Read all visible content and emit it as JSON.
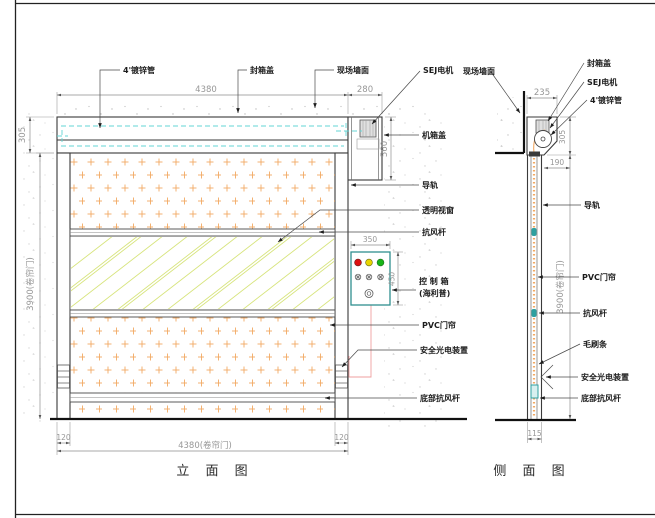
{
  "front": {
    "title": "立 面 图",
    "callout_pipe": "4'镀锌管",
    "callout_cover": "封箱盖",
    "callout_wall": "现场墙面",
    "callout_motor": "SEJ电机",
    "callout_motor_cover": "机箱盖",
    "callout_rail": "导轨",
    "callout_window": "透明视窗",
    "callout_windbar": "抗风杆",
    "callout_control1": "控 制 箱",
    "callout_control2": "(海利普)",
    "callout_curtain": "PVC门帘",
    "callout_photocell": "安全光电装置",
    "callout_bottombar": "底部抗风杆",
    "dim_width": "4380",
    "dim_head_w": "280",
    "dim_head_h": "305",
    "dim_box_h": "560",
    "dim_height": "3900(卷帘门)",
    "dim_panel_w": "350",
    "dim_panel_h": "450",
    "dim_rail_l": "120",
    "dim_rail_r": "120",
    "dim_opening": "4380(卷帘门)"
  },
  "side": {
    "title": "侧 面 图",
    "callout_wall": "现场墙面",
    "callout_cover": "封箱盖",
    "callout_motor": "SEJ电机",
    "callout_pipe": "4'镀锌管",
    "callout_rail": "导轨",
    "callout_curtain": "PVC门帘",
    "callout_windbar": "抗风杆",
    "callout_brush": "毛刷条",
    "callout_photocell": "安全光电装置",
    "callout_bottombar": "底部抗风杆",
    "dim_depth": "235",
    "dim_head_h": "305",
    "dim_offset": "190",
    "dim_height": "3900(卷帘门)",
    "dim_base": "115"
  },
  "colors": {
    "light_red": "#dd1111",
    "light_yellow": "#e8d500",
    "light_green": "#17b517",
    "curtain_dot": "#f2a963",
    "window_line": "#d7e47c",
    "roller_cyan": "#63d6d6",
    "control_border": "#2f8f8f",
    "wire_pink": "#ef9f9f"
  }
}
